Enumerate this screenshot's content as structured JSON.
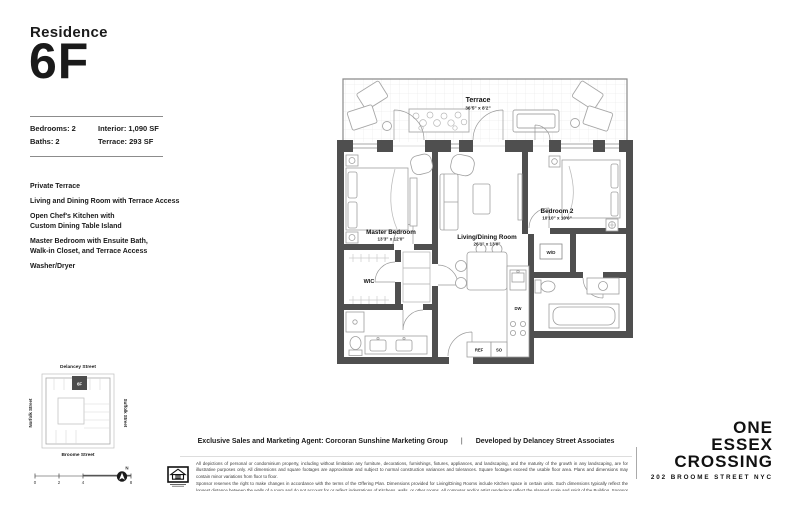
{
  "page": {
    "residence_label": "Residence",
    "unit_number": "6F"
  },
  "stats": {
    "bedrooms": "Bedrooms: 2",
    "baths": "Baths: 2",
    "interior": "Interior: 1,090 SF",
    "terrace": "Terrace: 293 SF"
  },
  "features": [
    "Private Terrace",
    "Living and Dining Room with Terrace Access",
    "Open Chef's Kitchen with\nCustom Dining Table Island",
    "Master Bedroom with Ensuite Bath,\nWalk-in Closet, and Terrace Access",
    "Washer/Dryer"
  ],
  "floorplan": {
    "terrace": {
      "name": "Terrace",
      "dims": "36'5\" x 8'2\""
    },
    "master_bedroom": {
      "name": "Master Bedroom",
      "dims": "13'3\" x 12'0\""
    },
    "living_dining": {
      "name": "Living/Dining Room",
      "dims": "26'1\" x 13'0\""
    },
    "bedroom_2": {
      "name": "Bedroom 2",
      "dims": "10'10\" x 10'6\""
    },
    "labels": {
      "wic": "WIC",
      "wd": "W/D",
      "dw": "DW",
      "ref": "REF",
      "so": "SO"
    }
  },
  "keyplan": {
    "street_top": "Delancey Street",
    "street_bottom": "Broome Street",
    "street_left": "Norfolk Street",
    "street_right": "Suffolk Street",
    "unit_marker": "6F"
  },
  "scalebar": {
    "ticks": [
      "0",
      "2",
      "4",
      "8"
    ],
    "north": "N"
  },
  "footer": {
    "agent": "Exclusive Sales and Marketing Agent: Corcoran Sunshine Marketing Group",
    "separator": "|",
    "developer": "Developed by Delancey Street Associates",
    "disclaimer_p1": "All depictions of personal or condominium property, including without limitation any furniture, decorations, furnishings, fixtures, appliances, and landscaping, and the maturity of the growth in any landscaping, are for illustrative purposes only. All dimensions and square footages are approximate and subject to normal construction variances and tolerances. Square footages exceed the usable floor area. Plans and dimensions may contain minor variations from floor to floor.",
    "disclaimer_p2": "Sponsor reserves the right to make changes in accordance with the terms of the Offering Plan. Dimensions provided for Living/Dining Rooms include Kitchen space in certain units. Such dimensions typically reflect the longest distance between the walls of a room and do not account for or reflect indentations of Kitchens, walls, or other rooms. All computer and/or artist renderings reflect the planned scale and spirit of the Building. Sponsor makes no representations or warranties except as may be set forth in the Offering Plan.",
    "offering": "THE COMPLETE OFFERING TERMS ARE IN AN OFFERING PLAN AVAILABLE FROM SPONSOR. FILE NO. CD16-0316. SPONSOR: SITE 2 DSA OWNER, LLC, C/O TACONIC INVESTMENT PARTNERS, 111 EIGHTH AVENUE, SUITE 1500, NEW YORK, NY 10011."
  },
  "brand": {
    "line1": "ONE",
    "line2": "ESSEX",
    "line3": "CROSSING",
    "address": "202 BROOME STREET NYC"
  },
  "colors": {
    "ink": "#1a1a1a",
    "wall": "#4f4f4f",
    "furniture_line": "#a0a0a0"
  }
}
